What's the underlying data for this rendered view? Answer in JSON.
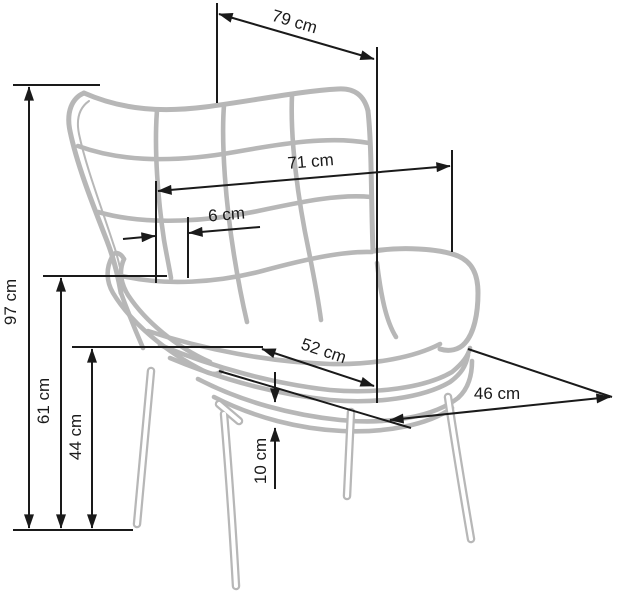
{
  "diagram": {
    "subject": "Wingback armchair dimensional line drawing",
    "unit": "cm",
    "colors": {
      "chair": "#b7b7b7",
      "dimension": "#1a1a1a",
      "background": "#ffffff"
    },
    "labels": {
      "top_width": "79 cm",
      "back_width": "71 cm",
      "wing_offset": "6 cm",
      "total_height": "97 cm",
      "armrest_height": "61 cm",
      "seat_height": "44 cm",
      "seat_width": "52 cm",
      "cushion_thickness": "10 cm",
      "seat_depth": "46 cm"
    },
    "values_cm": {
      "top_width": 79,
      "back_width": 71,
      "wing_offset": 6,
      "total_height": 97,
      "armrest_height": 61,
      "seat_height": 44,
      "seat_width": 52,
      "cushion_thickness": 10,
      "seat_depth": 46
    }
  }
}
